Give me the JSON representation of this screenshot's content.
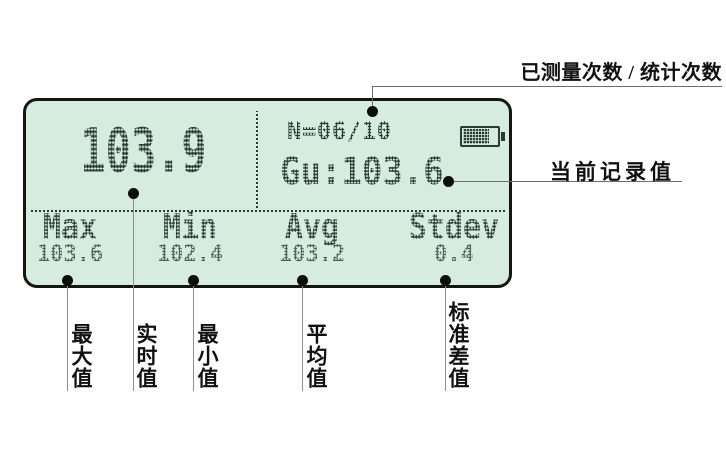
{
  "screen": {
    "main_reading": "103.9",
    "counter": "N=06/10",
    "current_record": "Gu:103.6",
    "battery_icon": "battery-mostly-full",
    "stats": [
      {
        "label": "Max",
        "value": "103.6"
      },
      {
        "label": "Min",
        "value": "102.4"
      },
      {
        "label": "Avg",
        "value": "103.2"
      },
      {
        "label": "Stdev",
        "value": "0.4"
      }
    ]
  },
  "annotations": {
    "counter_label": "已测量次数 / 统计次数",
    "current_record_label": "当前记录值",
    "bottom_labels": [
      "最大值",
      "实时值",
      "最小值",
      "平均值",
      "标准差值"
    ]
  },
  "colors": {
    "lcd_background": "#d5ecdf",
    "lcd_text": "#2b3a34",
    "lcd_value_text": "#4e5e56",
    "lcd_border": "#151515",
    "callout_line": "#8f8f8f",
    "annotation_text": "#111111"
  }
}
